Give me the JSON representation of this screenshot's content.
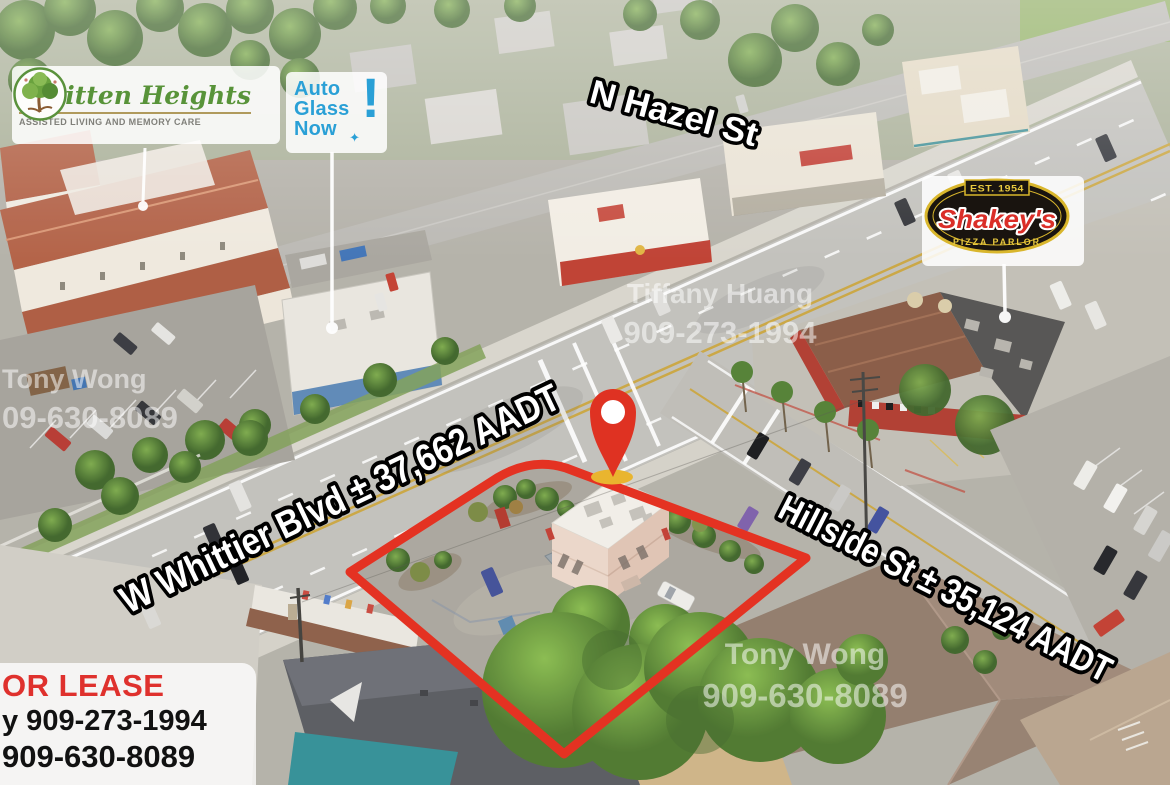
{
  "street_labels": {
    "hazel": "N Hazel St",
    "whittier": "W Whittier Blvd ± 37,662 AADT",
    "hillside": "Hillside St ± 35,124 AADT"
  },
  "signs": {
    "whitten": {
      "name": "Whitten Heights",
      "tagline": "ASSISTED LIVING AND MEMORY CARE"
    },
    "autoglass": {
      "word1": "Auto",
      "word2": "Glass",
      "word3": "Now",
      "mark": "!",
      "sparkle": "✦"
    },
    "shakeys": {
      "est": "EST. 1954",
      "name": "Shakey's",
      "tagline": "PIZZA PARLOR"
    }
  },
  "watermarks": {
    "center": {
      "line1": "Tiffany Huang",
      "line2": "909-273-1994"
    },
    "left": {
      "line1": "Tony Wong",
      "line2": "09-630-8089"
    },
    "bottom_right": {
      "line1": "Tony Wong",
      "line2": "909-630-8089"
    }
  },
  "lease_banner": {
    "title": "OR LEASE",
    "contact1": "y 909-273-1994",
    "contact2": "909-630-8089"
  },
  "colors": {
    "boundary_red": "#e43222",
    "pin_red": "#df3222",
    "lease_red": "#df312d",
    "autoglass_blue": "#2aa0d6",
    "whitten_green": "#589339",
    "shakeys_red": "#da2e28",
    "shakeys_gold": "#d9b62c",
    "watermark_white": "rgba(255,255,255,0.52)"
  }
}
